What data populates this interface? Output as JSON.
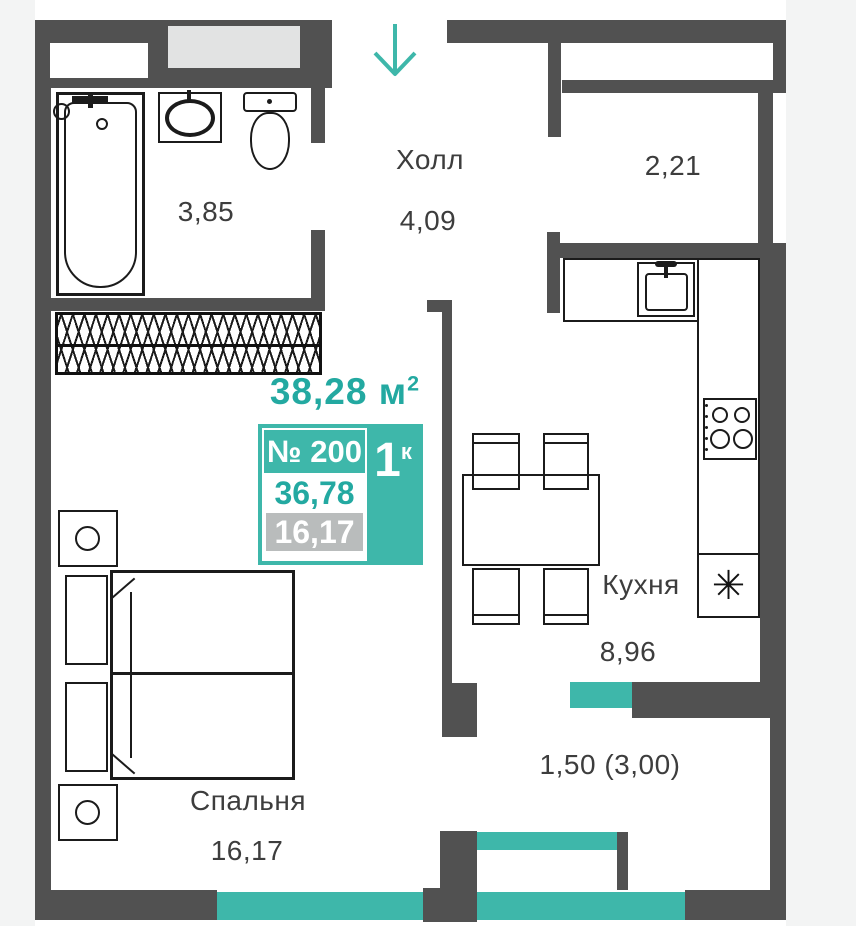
{
  "colors": {
    "accent_teal": "#3eb7aa",
    "accent_teal_text": "#23a9a1",
    "wall_gray": "#515151",
    "card_gray": "#b9bcbc",
    "shaft_gray": "#e2e3e3",
    "page_side_gray": "#f3f4f4",
    "label_text": "#3d3d3d"
  },
  "title_area": {
    "value": "38,28",
    "unit": "м",
    "sup": "2"
  },
  "unit_card": {
    "number": "№ 200",
    "rooms": "1",
    "rooms_sup": "к",
    "total_area": "36,78",
    "living_area": "16,17"
  },
  "rooms": {
    "hall": {
      "name": "Холл",
      "area": "4,09"
    },
    "bathroom": {
      "area": "3,85"
    },
    "storage": {
      "area": "2,21"
    },
    "kitchen": {
      "name": "Кухня",
      "area": "8,96"
    },
    "bedroom": {
      "name": "Спальня",
      "area": "16,17"
    },
    "balcony": {
      "area": "1,50 (3,00)"
    }
  },
  "icons": {
    "entrance_arrow": "down-arrow",
    "fridge_symbol": "✳"
  }
}
